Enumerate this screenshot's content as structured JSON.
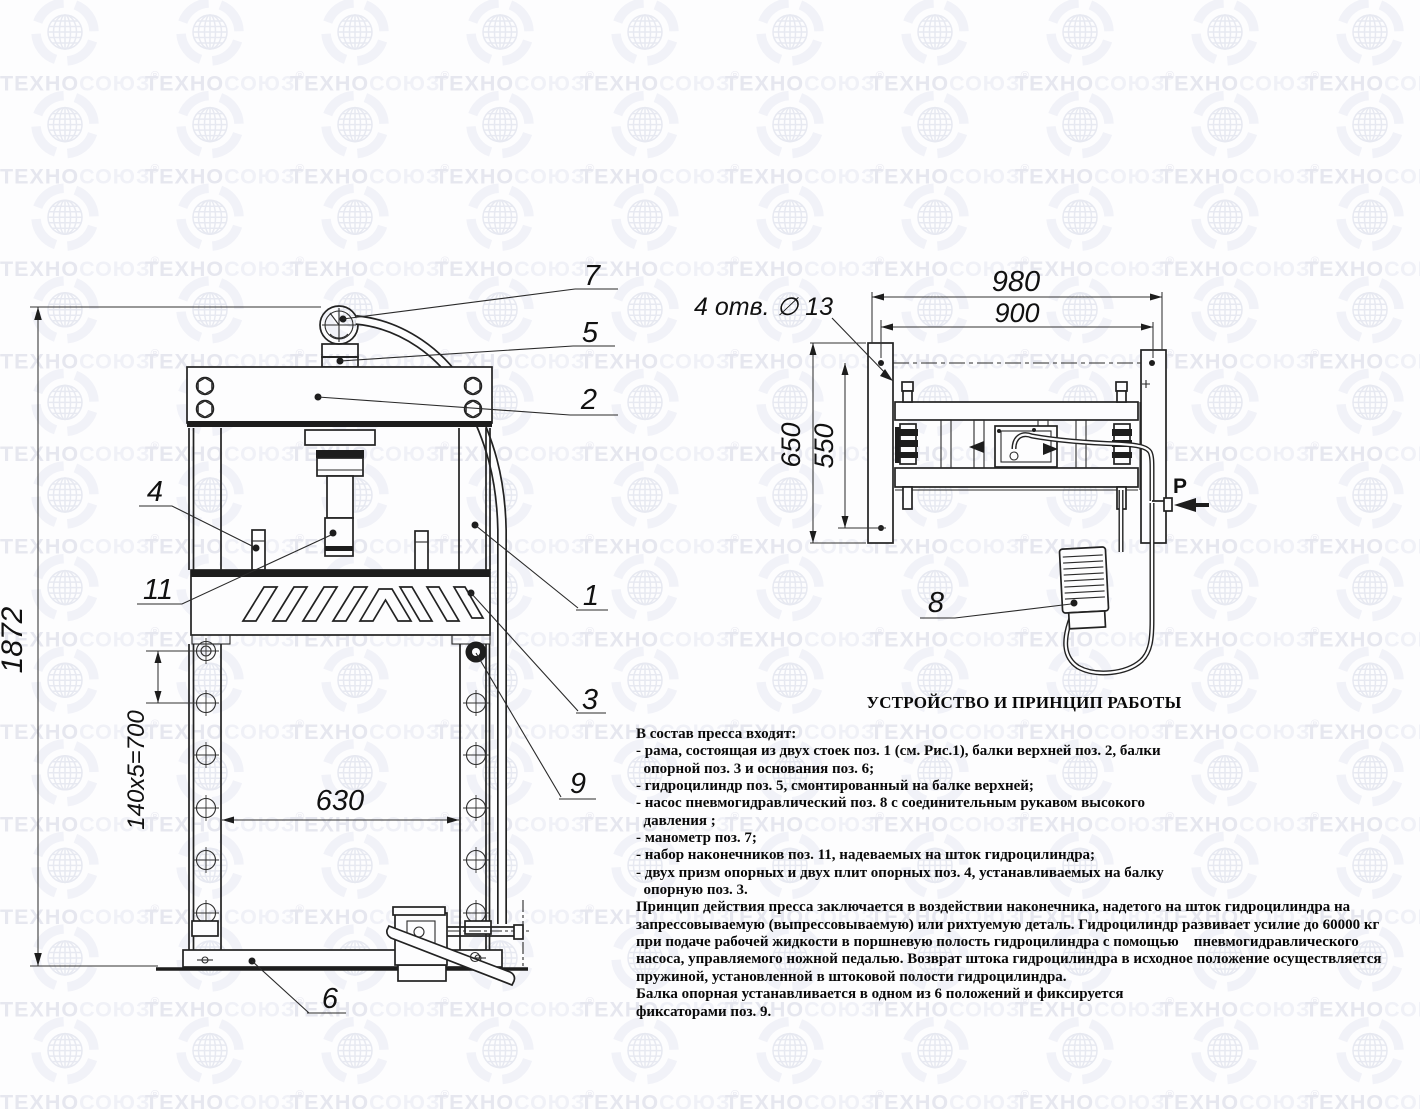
{
  "watermark": {
    "brand": "ТЕХНОСОЮЗ",
    "registered": "®"
  },
  "front_view": {
    "dim_height": "1872",
    "dim_hole_pitch": "140x5=700",
    "dim_table_width": "630",
    "callout_manometer": "7",
    "callout_cylinder": "5",
    "callout_top_beam": "2",
    "callout_post": "1",
    "callout_support_beam": "3",
    "callout_fixator": "9",
    "callout_base": "6",
    "callout_support_plate": "4",
    "callout_tip": "11"
  },
  "top_view": {
    "dim_width_overall": "980",
    "dim_width_holes": "900",
    "dim_depth_overall": "650",
    "dim_depth_holes": "550",
    "holes_note": "4 отв. ∅ 13",
    "callout_pump": "8",
    "pressure_label": "P"
  },
  "description": {
    "title": "УСТРОЙСТВО И ПРИНЦИП РАБОТЫ",
    "lines": [
      "В состав пресса входят:",
      "- рама, состоящая из двух стоек поз. 1 (см. Рис.1), балки верхней поз. 2, балки",
      "  опорной поз. 3 и основания поз. 6;",
      "- гидроцилиндр поз. 5, смонтированный на балке верхней;",
      "- насос пневмогидравлический поз. 8 с соединительным рукавом высокого",
      "  давления ;",
      "- манометр поз. 7;",
      "- набор наконечников поз. 11, надеваемых на шток гидроцилиндра;",
      "- двух призм опорных и двух плит опорных поз. 4, устанавливаемых на балку",
      "  опорную поз. 3.",
      "Принцип действия пресса заключается в воздействии наконечника, надетого на шток гидроцилиндра на",
      "запрессовываемую (выпрессовываемую) или рихтуемую деталь. Гидроцилиндр развивает усилие до 60000 кг",
      "при подаче рабочей жидкости в поршневую полость гидроцилиндра с помощью    пневмогидравлического",
      "насоса, управляемого ножной педалью. Возврат штока гидроцилиндра в исходное положение осуществляется",
      "пружиной, установленной в штоковой полости гидроцилиндра.",
      "Балка опорная устанавливается в одном из 6 положений и фиксируется",
      "фиксаторами поз. 9."
    ]
  }
}
